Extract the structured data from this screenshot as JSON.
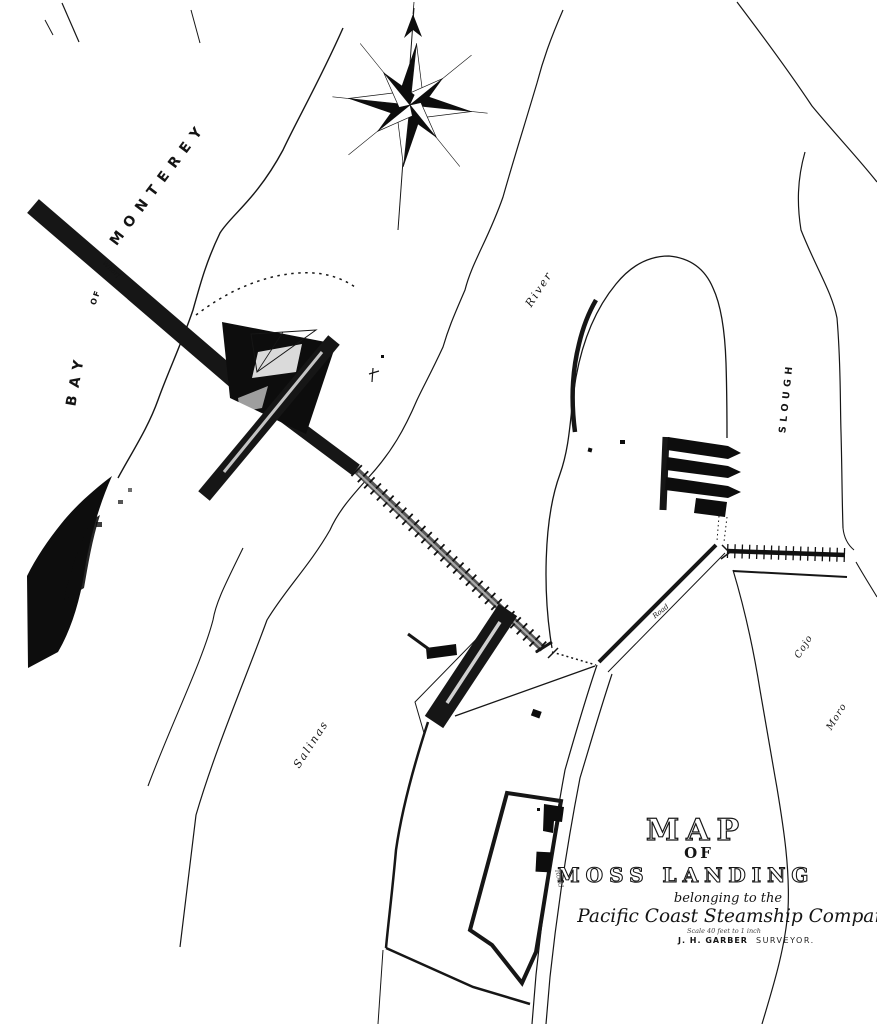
{
  "map": {
    "paper_color": "#ffffff",
    "ink_color": "#161616",
    "water_labels": {
      "bay": "BAY",
      "of": "OF",
      "monterey": "MONTEREY",
      "river": "River",
      "salinas": "Salinas",
      "slough": "SLOUGH",
      "cojo": "Cojo",
      "moro": "Moro"
    },
    "feature_labels": {
      "wharf": "Wharf",
      "road_main": "Road",
      "road_south": "Road"
    },
    "title_block": {
      "title": "MAP",
      "of": "OF",
      "place": "MOSS LANDING",
      "belonging": "belonging to the",
      "company": "Pacific Coast Steamship Company",
      "scale_note": "Scale 40 feet to 1 inch",
      "surveyor_name": "J. H. GARBER",
      "surveyor_title": "SURVEYOR."
    }
  }
}
